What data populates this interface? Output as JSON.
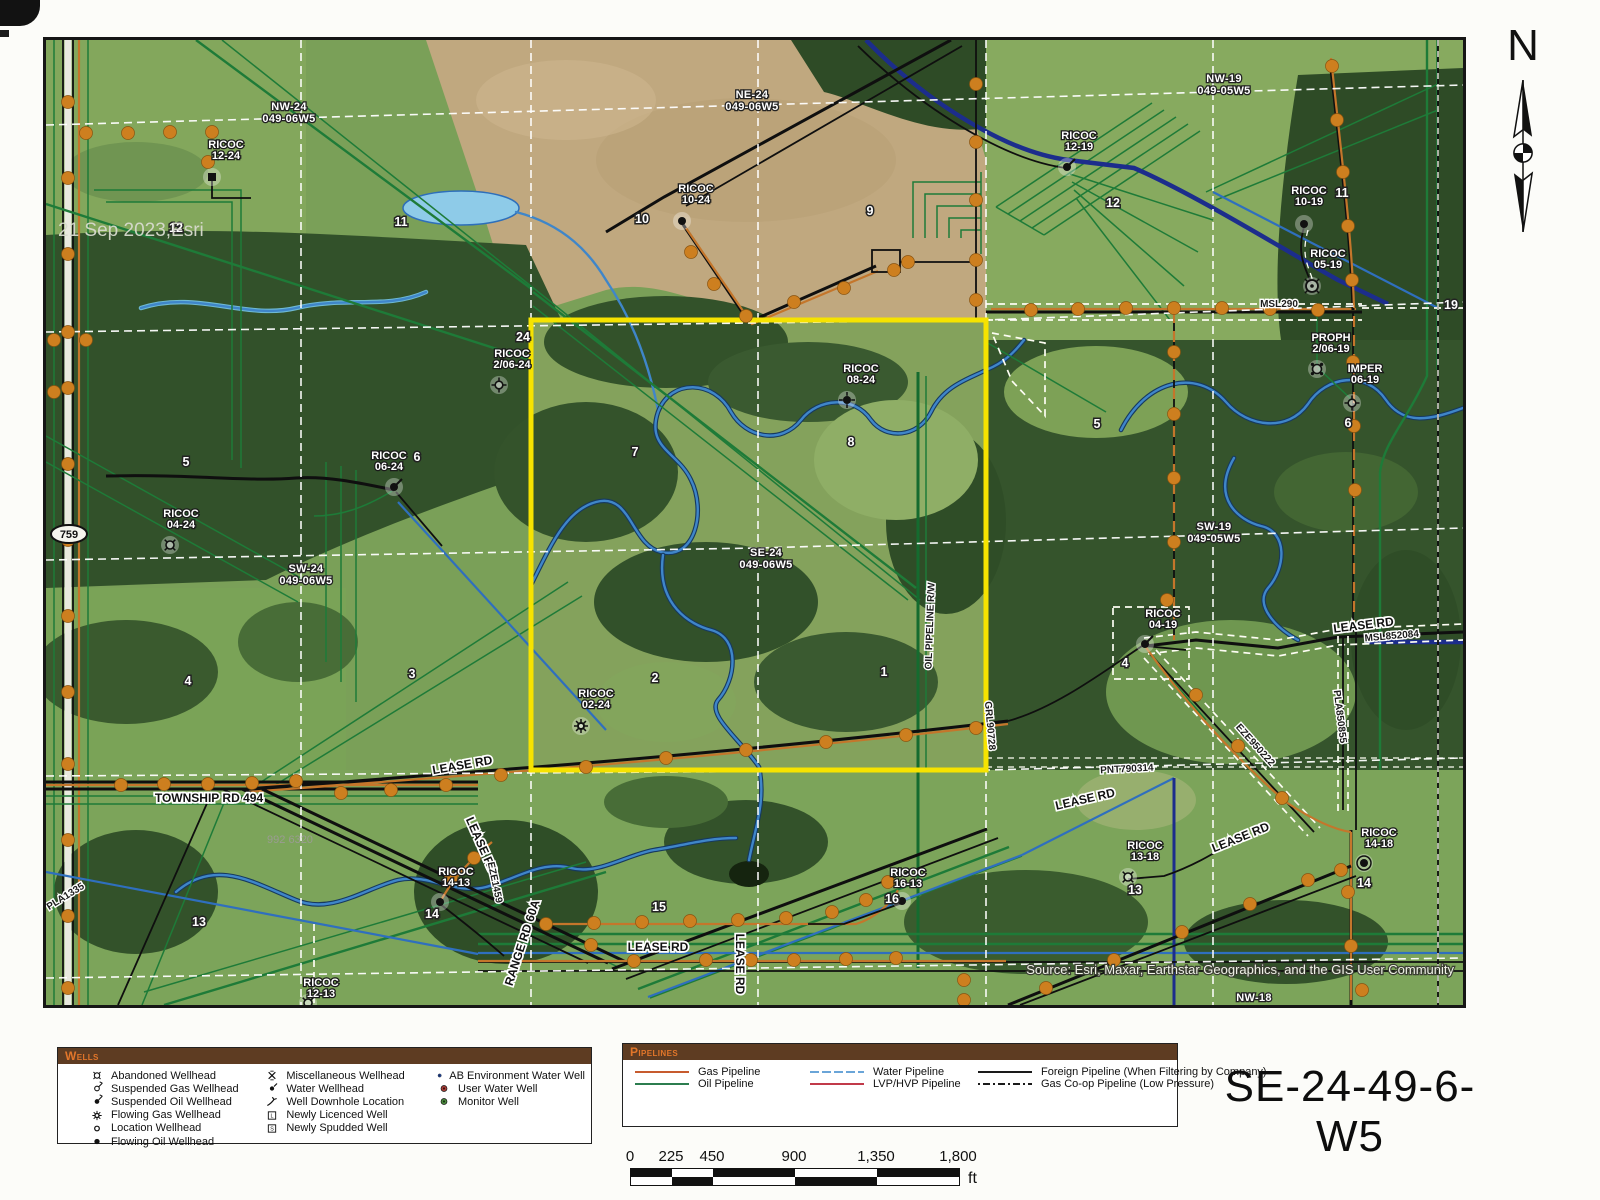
{
  "title": "SE-24-49-6-W5",
  "north": {
    "label": "N"
  },
  "map": {
    "date_text": "21 Sep 2023,Esri",
    "source_text": "Source: Esri, Maxar, Earthstar Geographics, and the GIS User Community",
    "highway_shield": "759",
    "quarter_labels": [
      {
        "l1": "NW-24",
        "l2": "049-06W5",
        "x": 243,
        "y": 70
      },
      {
        "l1": "NE-24",
        "l2": "049-06W5",
        "x": 706,
        "y": 58
      },
      {
        "l1": "NW-19",
        "l2": "049-05W5",
        "x": 1178,
        "y": 42
      },
      {
        "l1": "SW-24",
        "l2": "049-06W5",
        "x": 260,
        "y": 532
      },
      {
        "l1": "SE-24",
        "l2": "049-06W5",
        "x": 720,
        "y": 516
      },
      {
        "l1": "SW-19",
        "l2": "049-05W5",
        "x": 1168,
        "y": 490
      },
      {
        "l1": "NW-18",
        "l2": "",
        "x": 1208,
        "y": 961
      }
    ],
    "section_numbers": [
      {
        "t": "24",
        "x": 477,
        "y": 301
      },
      {
        "t": "12",
        "x": 130,
        "y": 192
      },
      {
        "t": "11",
        "x": 355,
        "y": 186
      },
      {
        "t": "10",
        "x": 596,
        "y": 183
      },
      {
        "t": "9",
        "x": 824,
        "y": 175
      },
      {
        "t": "12",
        "x": 1067,
        "y": 167
      },
      {
        "t": "11",
        "x": 1296,
        "y": 157
      },
      {
        "t": "19",
        "x": 1405,
        "y": 269
      },
      {
        "t": "5",
        "x": 140,
        "y": 426
      },
      {
        "t": "6",
        "x": 371,
        "y": 421
      },
      {
        "t": "7",
        "x": 589,
        "y": 416
      },
      {
        "t": "8",
        "x": 805,
        "y": 406
      },
      {
        "t": "5",
        "x": 1051,
        "y": 388
      },
      {
        "t": "6",
        "x": 1302,
        "y": 387
      },
      {
        "t": "4",
        "x": 142,
        "y": 645
      },
      {
        "t": "3",
        "x": 366,
        "y": 638
      },
      {
        "t": "2",
        "x": 609,
        "y": 642
      },
      {
        "t": "1",
        "x": 838,
        "y": 636
      },
      {
        "t": "4",
        "x": 1079,
        "y": 627
      },
      {
        "t": "13",
        "x": 153,
        "y": 886
      },
      {
        "t": "14",
        "x": 386,
        "y": 878
      },
      {
        "t": "15",
        "x": 613,
        "y": 871
      },
      {
        "t": "16",
        "x": 846,
        "y": 863
      },
      {
        "t": "13",
        "x": 1089,
        "y": 854
      },
      {
        "t": "14",
        "x": 1318,
        "y": 847
      }
    ],
    "well_labels": [
      {
        "l1": "RICOC",
        "l2": "12-24",
        "x": 180,
        "y": 108,
        "sx": 166,
        "sy": 137,
        "sym": "square-dot"
      },
      {
        "l1": "RICOC",
        "l2": "10-24",
        "x": 650,
        "y": 152,
        "sx": 636,
        "sy": 181,
        "sym": "dot"
      },
      {
        "l1": "RICOC",
        "l2": "12-19",
        "x": 1033,
        "y": 99,
        "sx": 1021,
        "sy": 127,
        "sym": "dot-tail"
      },
      {
        "l1": "RICOC",
        "l2": "10-19",
        "x": 1263,
        "y": 154,
        "sx": 1258,
        "sy": 184,
        "sym": "dot"
      },
      {
        "l1": "RICOC",
        "l2": "05-19",
        "x": 1282,
        "y": 217,
        "sx": 1266,
        "sy": 246,
        "sym": "circle-cross-lg"
      },
      {
        "l1": "PROPH",
        "l2": "2/06-19",
        "x": 1285,
        "y": 301,
        "sx": 1271,
        "sy": 329,
        "sym": "circle-dots"
      },
      {
        "l1": "IMPER",
        "l2": "06-19",
        "x": 1319,
        "y": 332,
        "sx": 1306,
        "sy": 363,
        "sym": "circle-spokes"
      },
      {
        "l1": "RICOC",
        "l2": "2/06-24",
        "x": 466,
        "y": 317,
        "sx": 453,
        "sy": 345,
        "sym": "circle-spokes"
      },
      {
        "l1": "RICOC",
        "l2": "08-24",
        "x": 815,
        "y": 332,
        "sx": 801,
        "sy": 360,
        "sym": "dot-spokes"
      },
      {
        "l1": "RICOC",
        "l2": "06-24",
        "x": 343,
        "y": 419,
        "sx": 348,
        "sy": 447,
        "sym": "dot-tail"
      },
      {
        "l1": "RICOC",
        "l2": "04-24",
        "x": 135,
        "y": 477,
        "sx": 124,
        "sy": 505,
        "sym": "circle-cross"
      },
      {
        "l1": "RICOC",
        "l2": "02-24",
        "x": 550,
        "y": 657,
        "sx": 535,
        "sy": 686,
        "sym": "circle-rays"
      },
      {
        "l1": "RICOC",
        "l2": "04-19",
        "x": 1117,
        "y": 577,
        "sx": 1099,
        "sy": 604,
        "sym": "dot-tail"
      },
      {
        "l1": "RICOC",
        "l2": "14-13",
        "x": 410,
        "y": 835,
        "sx": 394,
        "sy": 862,
        "sym": "dot"
      },
      {
        "l1": "RICOC",
        "l2": "16-13",
        "x": 862,
        "y": 836,
        "sx": 856,
        "sy": 861,
        "sym": "dot"
      },
      {
        "l1": "RICOC",
        "l2": "12-13",
        "x": 275,
        "y": 946,
        "sx": 262,
        "sy": 963,
        "sym": "circle-cross"
      },
      {
        "l1": "RICOC",
        "l2": "13-18",
        "x": 1099,
        "y": 809,
        "sx": 1082,
        "sy": 837,
        "sym": "circle-cross"
      },
      {
        "l1": "RICOC",
        "l2": "14-18",
        "x": 1333,
        "y": 796,
        "sx": 1318,
        "sy": 823,
        "sym": "dot-ring"
      }
    ],
    "road_labels": [
      {
        "t": "LEASE RD",
        "x": 417,
        "y": 729,
        "r": -10
      },
      {
        "t": "TOWNSHIP RD 494",
        "x": 163,
        "y": 762,
        "r": 0
      },
      {
        "t": "LEASE RD",
        "x": 432,
        "y": 807,
        "r": 66
      },
      {
        "t": "RANGE RD 60A",
        "x": 480,
        "y": 904,
        "r": -72
      },
      {
        "t": "LEASE RD",
        "x": 612,
        "y": 911,
        "r": 0
      },
      {
        "t": "LEASE RD",
        "x": 690,
        "y": 924,
        "r": 90
      },
      {
        "t": "LEASE RD",
        "x": 1040,
        "y": 763,
        "r": -13
      },
      {
        "t": "LEASE RD",
        "x": 1318,
        "y": 589,
        "r": -7
      },
      {
        "t": "LEASE RD",
        "x": 1196,
        "y": 801,
        "r": -22
      }
    ],
    "plan_labels": [
      {
        "t": "MSL290",
        "x": 1233,
        "y": 267,
        "r": 0
      },
      {
        "t": "MSL852084",
        "x": 1346,
        "y": 599,
        "r": -5
      },
      {
        "t": "PLA850855",
        "x": 1291,
        "y": 677,
        "r": 83
      },
      {
        "t": "EZE950222",
        "x": 1207,
        "y": 707,
        "r": 48
      },
      {
        "t": "PNT790314",
        "x": 1081,
        "y": 732,
        "r": -3
      },
      {
        "t": "GRL90728",
        "x": 941,
        "y": 686,
        "r": 85
      },
      {
        "t": "EZE1459",
        "x": 446,
        "y": 843,
        "r": 78
      },
      {
        "t": "PLA1335",
        "x": 21,
        "y": 859,
        "r": -32
      },
      {
        "t": "OIL PIPELINE R/W",
        "x": 887,
        "y": 586,
        "r": -88
      },
      {
        "t": "992 6320",
        "x": 244,
        "y": 803,
        "r": 0,
        "g": true
      }
    ]
  },
  "legend_wells": {
    "title": "Wells",
    "items": [
      {
        "sym": "circle-cross",
        "label": "Abandoned Wellhead"
      },
      {
        "sym": "gas-flag",
        "label": "Suspended Gas Wellhead"
      },
      {
        "sym": "oil-flag",
        "label": "Suspended Oil Wellhead"
      },
      {
        "sym": "circle-rays",
        "label": "Flowing Gas Wellhead"
      },
      {
        "sym": "circle",
        "label": "Location Wellhead"
      },
      {
        "sym": "dot",
        "label": "Flowing Oil Wellhead"
      },
      {
        "sym": "misc-x",
        "label": "Miscellaneous Wellhead"
      },
      {
        "sym": "water-wh",
        "label": "Water Wellhead"
      },
      {
        "sym": "downhole",
        "label": "Well Downhole Location"
      },
      {
        "sym": "newly-lic",
        "label": "Newly Licenced Well"
      },
      {
        "sym": "newly-spud",
        "label": "Newly Spudded Well"
      },
      {
        "sym": "ab-env",
        "label": "AB Environment Water Well"
      },
      {
        "sym": "user-water",
        "label": "User Water Well"
      },
      {
        "sym": "monitor",
        "label": "Monitor Well"
      }
    ]
  },
  "legend_pipelines": {
    "title": "Pipelines",
    "items": [
      {
        "label": "Gas Pipeline",
        "color": "#c75b2e",
        "dash": ""
      },
      {
        "label": "Oil Pipeline",
        "color": "#2c7d4f",
        "dash": ""
      },
      {
        "label": "Water Pipeline",
        "color": "#6aa5d8",
        "dash": "9 3"
      },
      {
        "label": "LVP/HVP Pipeline",
        "color": "#c13a4a",
        "dash": ""
      },
      {
        "label": "Foreign Pipeline (When Filtering by Company)",
        "color": "#1a1a1a",
        "dash": ""
      },
      {
        "label": "Gas Co-op Pipeline (Low Pressure)",
        "color": "#1a1a1a",
        "dash": "2 3 7 3"
      }
    ]
  },
  "scalebar": {
    "labels": [
      "0",
      "225",
      "450",
      "900",
      "1,350",
      "1,800"
    ],
    "unit": "ft"
  },
  "colors": {
    "highlight": "#f6e300",
    "node": "#cd7f1f",
    "legend_header_bg": "#5e3c22",
    "legend_header_text": "#e2762a"
  }
}
